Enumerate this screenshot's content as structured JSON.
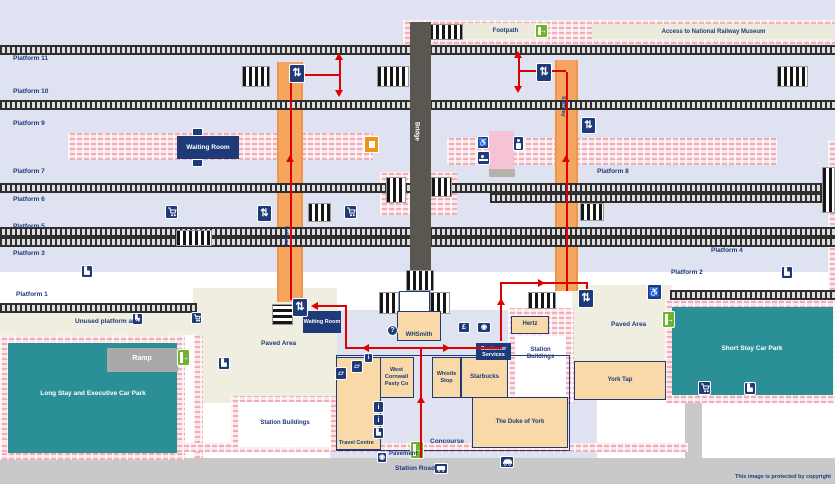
{
  "colors": {
    "navy": "#1e3a78",
    "red": "#e10000",
    "teal": "#2b8f97",
    "subway_orange": "#f6a55e",
    "bridge_grey": "#5a5650",
    "entrance_green": "#6cb52d",
    "lavender": "#dfe2f1",
    "cream": "#efeee1",
    "shop_tan": "#f9d9a8",
    "hatch_pink": "#f2aeb8",
    "road_grey": "#c9c9c9"
  },
  "top_band": {
    "footpath": "Footpath",
    "museum_access": "Access to National Railway Museum"
  },
  "platforms": {
    "p1": "Platform 1",
    "p2": "Platform 2",
    "p3": "Platform 3",
    "p4": "Platform 4",
    "p5": "Platform 5",
    "p6": "Platform 6",
    "p7": "Platform 7",
    "p8": "Platform 8",
    "p9": "Platform 9",
    "p10": "Platform 10",
    "p11": "Platform 11"
  },
  "structures": {
    "bridge": "Bridge",
    "subway": "Subway",
    "waiting_room": "Waiting Room"
  },
  "areas": {
    "unused_platform": "Unused platform area",
    "paved_area": "Paved Area",
    "ramp": "Ramp",
    "long_stay_car_park": "Long Stay and Executive Car Park",
    "short_stay_car_park": "Short Stay Car Park",
    "station_buildings": "Station Buildings",
    "concourse": "Concourse",
    "pavement": "Pavement",
    "station_road": "Station Road"
  },
  "venues": {
    "whsmith": "WHSmith",
    "hertz": "Hertz",
    "customer_services": "Customer Services",
    "west_cornwall_pasty": "West Cornwall Pasty Co",
    "whistle_stop": "Whistle Stop",
    "starbucks": "Starbucks",
    "duke_of_york": "The Duke of York",
    "travel_centre": "Travel Centre",
    "york_tap": "York Tap"
  },
  "icons": {
    "lift": "⇅",
    "stairs": "▙",
    "wheelchair": "♿",
    "information": "?",
    "cash_machine": "£",
    "photo_booth": "◉",
    "ticket_office": "▱",
    "ticket_machine": "i",
    "post_box": "◉",
    "entrance_arrow": "→"
  },
  "copyright": "This image is protected by copyright"
}
